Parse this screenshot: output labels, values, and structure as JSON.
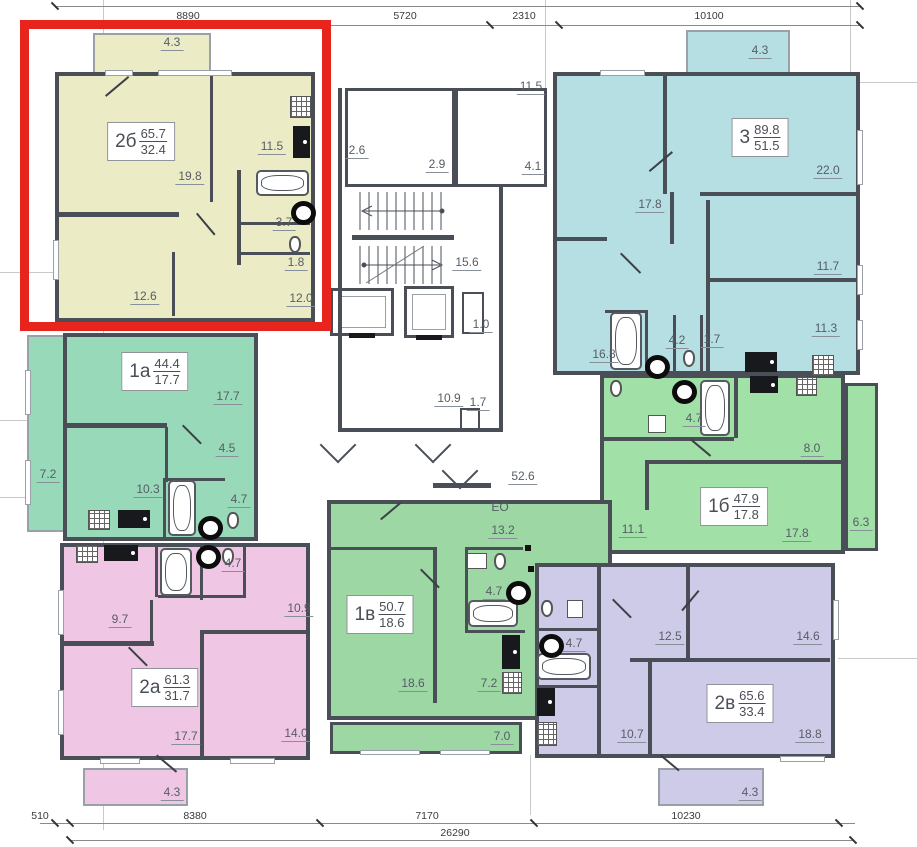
{
  "dimensions": {
    "top": [
      "8890",
      "5720",
      "2310",
      "10100"
    ],
    "bottom": [
      "510",
      "8380",
      "7170",
      "10230"
    ],
    "total": "26290"
  },
  "highlight_color": "#e8251c",
  "apartments": {
    "a2b": {
      "code": "2б",
      "total": "65.7",
      "living": "32.4",
      "color": "#ebecc6",
      "highlighted": true,
      "rooms": {
        "balcony": "4.3",
        "living": "19.8",
        "kitchen": "11.5",
        "bath": "3.7",
        "wc": "1.8",
        "bedroom": "12.6",
        "hall": "12.0"
      }
    },
    "a3": {
      "code": "3",
      "total": "89.8",
      "living": "51.5",
      "color": "#b5dfe2",
      "highlighted": false,
      "rooms": {
        "balcony": "4.3",
        "bedroom1": "17.8",
        "living": "22.0",
        "bedroom2": "11.7",
        "kitchen": "11.3",
        "hall": "16.8",
        "bath": "4.2",
        "wc": "1.7"
      }
    },
    "a1a": {
      "code": "1а",
      "total": "44.4",
      "living": "17.7",
      "color": "#97d9b9",
      "highlighted": false,
      "rooms": {
        "living": "17.7",
        "hall": "4.5",
        "balcony": "7.2",
        "kitchen": "10.3",
        "bath": "4.7"
      }
    },
    "a1b": {
      "code": "1б",
      "total": "47.9",
      "living": "17.8",
      "color": "#a1e0a6",
      "highlighted": false,
      "rooms": {
        "bath": "4.7",
        "kitchen": "8.0",
        "hall": "11.1",
        "living": "17.8",
        "balcony": "6.3"
      }
    },
    "a2a": {
      "code": "2а",
      "total": "61.3",
      "living": "31.7",
      "color": "#efc6e4",
      "highlighted": false,
      "rooms": {
        "kitchen": "9.7",
        "bath": "4.7",
        "bedroom": "10.9",
        "living": "17.7",
        "bedroom2": "14.0",
        "balcony": "4.3"
      }
    },
    "a1v": {
      "code": "1в",
      "total": "50.7",
      "living": "18.6",
      "color": "#9dd7a4",
      "highlighted": false,
      "annotation": "ЕО",
      "rooms": {
        "kitchen": "13.2",
        "bath": "4.7",
        "living": "18.6",
        "hall": "7.2",
        "loggia": "7.0"
      }
    },
    "a2v": {
      "code": "2в",
      "total": "65.6",
      "living": "33.4",
      "color": "#cecbe8",
      "highlighted": false,
      "rooms": {
        "bedroom1": "12.5",
        "bedroom2": "14.6",
        "kitchen": "10.7",
        "living": "18.8",
        "bath": "4.7",
        "balcony": "4.3"
      }
    }
  },
  "common": {
    "lobby": "2.6",
    "vestibule": "2.9",
    "hall": "4.1",
    "entry": "11.5",
    "stairwell": "15.6",
    "shaft_a": "1.0",
    "corridor": "10.9",
    "shaft_b": "1.7",
    "floor_corridor": "52.6"
  }
}
